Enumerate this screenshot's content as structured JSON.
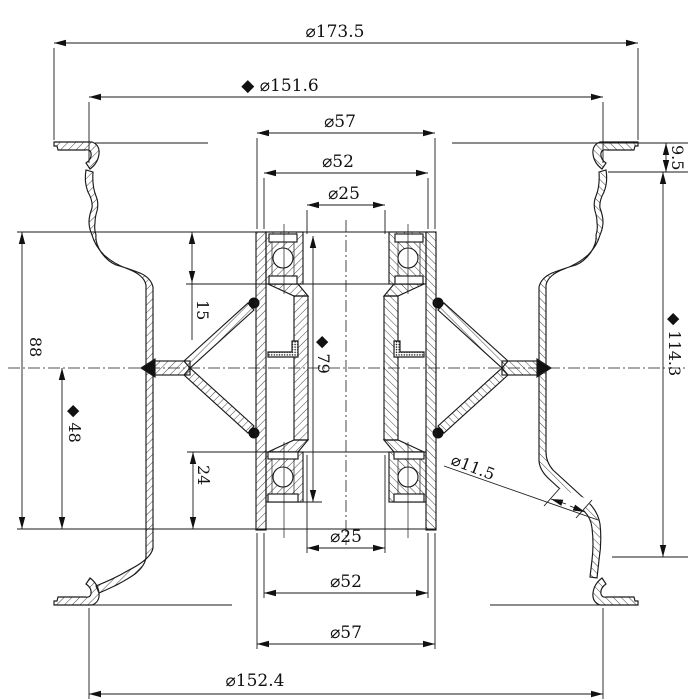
{
  "meta": {
    "title": "Wheel rim and hub bearing cross-section technical drawing",
    "background_color": "#ffffff",
    "line_color": "#1a1a1a",
    "diameter_symbol": "⌀",
    "inspection_marker": "◆"
  },
  "dims": {
    "overall_od_top": "⌀173.5",
    "bead_od_top": "◆ ⌀151.6",
    "hub_flange_od_top": "⌀57",
    "hub_body_od_top": "⌀52",
    "bore_od_top": "⌀25",
    "hub_length": "88",
    "bearing_seat_depth_top": "15",
    "hub_half_length": "◆ 48",
    "bearing_seat_depth_bottom": "24",
    "bearing_span": "◆ 79",
    "flange_drop": "9.5",
    "rim_width": "◆ 114.3",
    "valve_hole": "⌀11.5",
    "bore_od_bottom": "⌀25",
    "hub_body_od_bottom": "⌀52",
    "hub_flange_od_bottom": "⌀57",
    "bead_od_bottom": "⌀152.4"
  }
}
